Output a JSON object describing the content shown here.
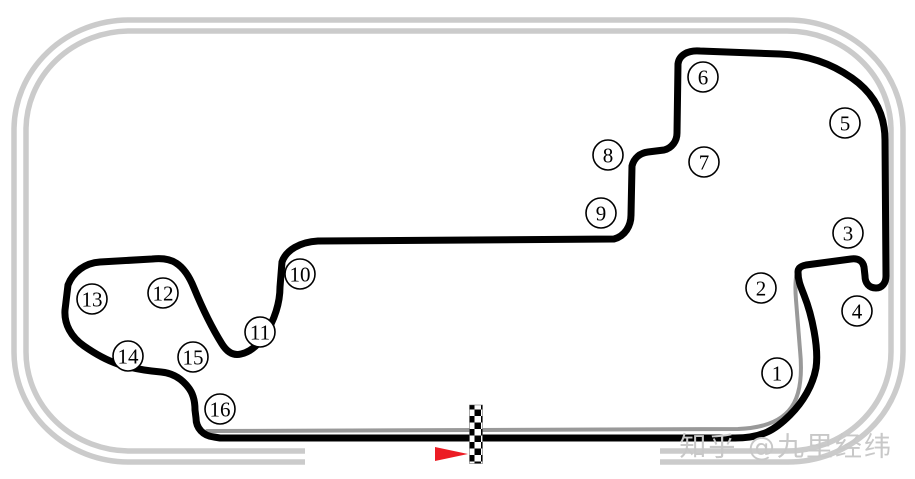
{
  "map": {
    "type": "race-track-map",
    "description_visible_elements": "oval speedway with infield road course, 16 numbered turns, start-finish checker strip, direction arrow"
  },
  "colors": {
    "road_course": "#000000",
    "oval_shared_line": "#999999",
    "oval_ring": "#cbcbcb",
    "checker": "#000000",
    "arrow": "#ec1c24",
    "marker_fill": "#ffffff",
    "marker_stroke": "#000000",
    "watermark": "#c8c8c8",
    "background": "#ffffff"
  },
  "track": {
    "marker_radius": 15,
    "turns": [
      {
        "label": "1",
        "x": 777,
        "y": 373
      },
      {
        "label": "2",
        "x": 761,
        "y": 288
      },
      {
        "label": "3",
        "x": 848,
        "y": 233
      },
      {
        "label": "4",
        "x": 857,
        "y": 311
      },
      {
        "label": "5",
        "x": 845,
        "y": 123
      },
      {
        "label": "6",
        "x": 703,
        "y": 77
      },
      {
        "label": "7",
        "x": 704,
        "y": 162
      },
      {
        "label": "8",
        "x": 608,
        "y": 155
      },
      {
        "label": "9",
        "x": 601,
        "y": 213
      },
      {
        "label": "10",
        "x": 300,
        "y": 274
      },
      {
        "label": "11",
        "x": 260,
        "y": 332
      },
      {
        "label": "12",
        "x": 163,
        "y": 293
      },
      {
        "label": "13",
        "x": 92,
        "y": 299
      },
      {
        "label": "14",
        "x": 128,
        "y": 356
      },
      {
        "label": "15",
        "x": 193,
        "y": 357
      },
      {
        "label": "16",
        "x": 220,
        "y": 409
      }
    ]
  },
  "start_finish": {
    "x": 469.5,
    "y": 405,
    "width": 13,
    "height": 58.5
  },
  "direction_arrow": {
    "points": "435,447 468,454 435,461"
  },
  "watermark": {
    "text": "知乎 @九里经纬"
  }
}
